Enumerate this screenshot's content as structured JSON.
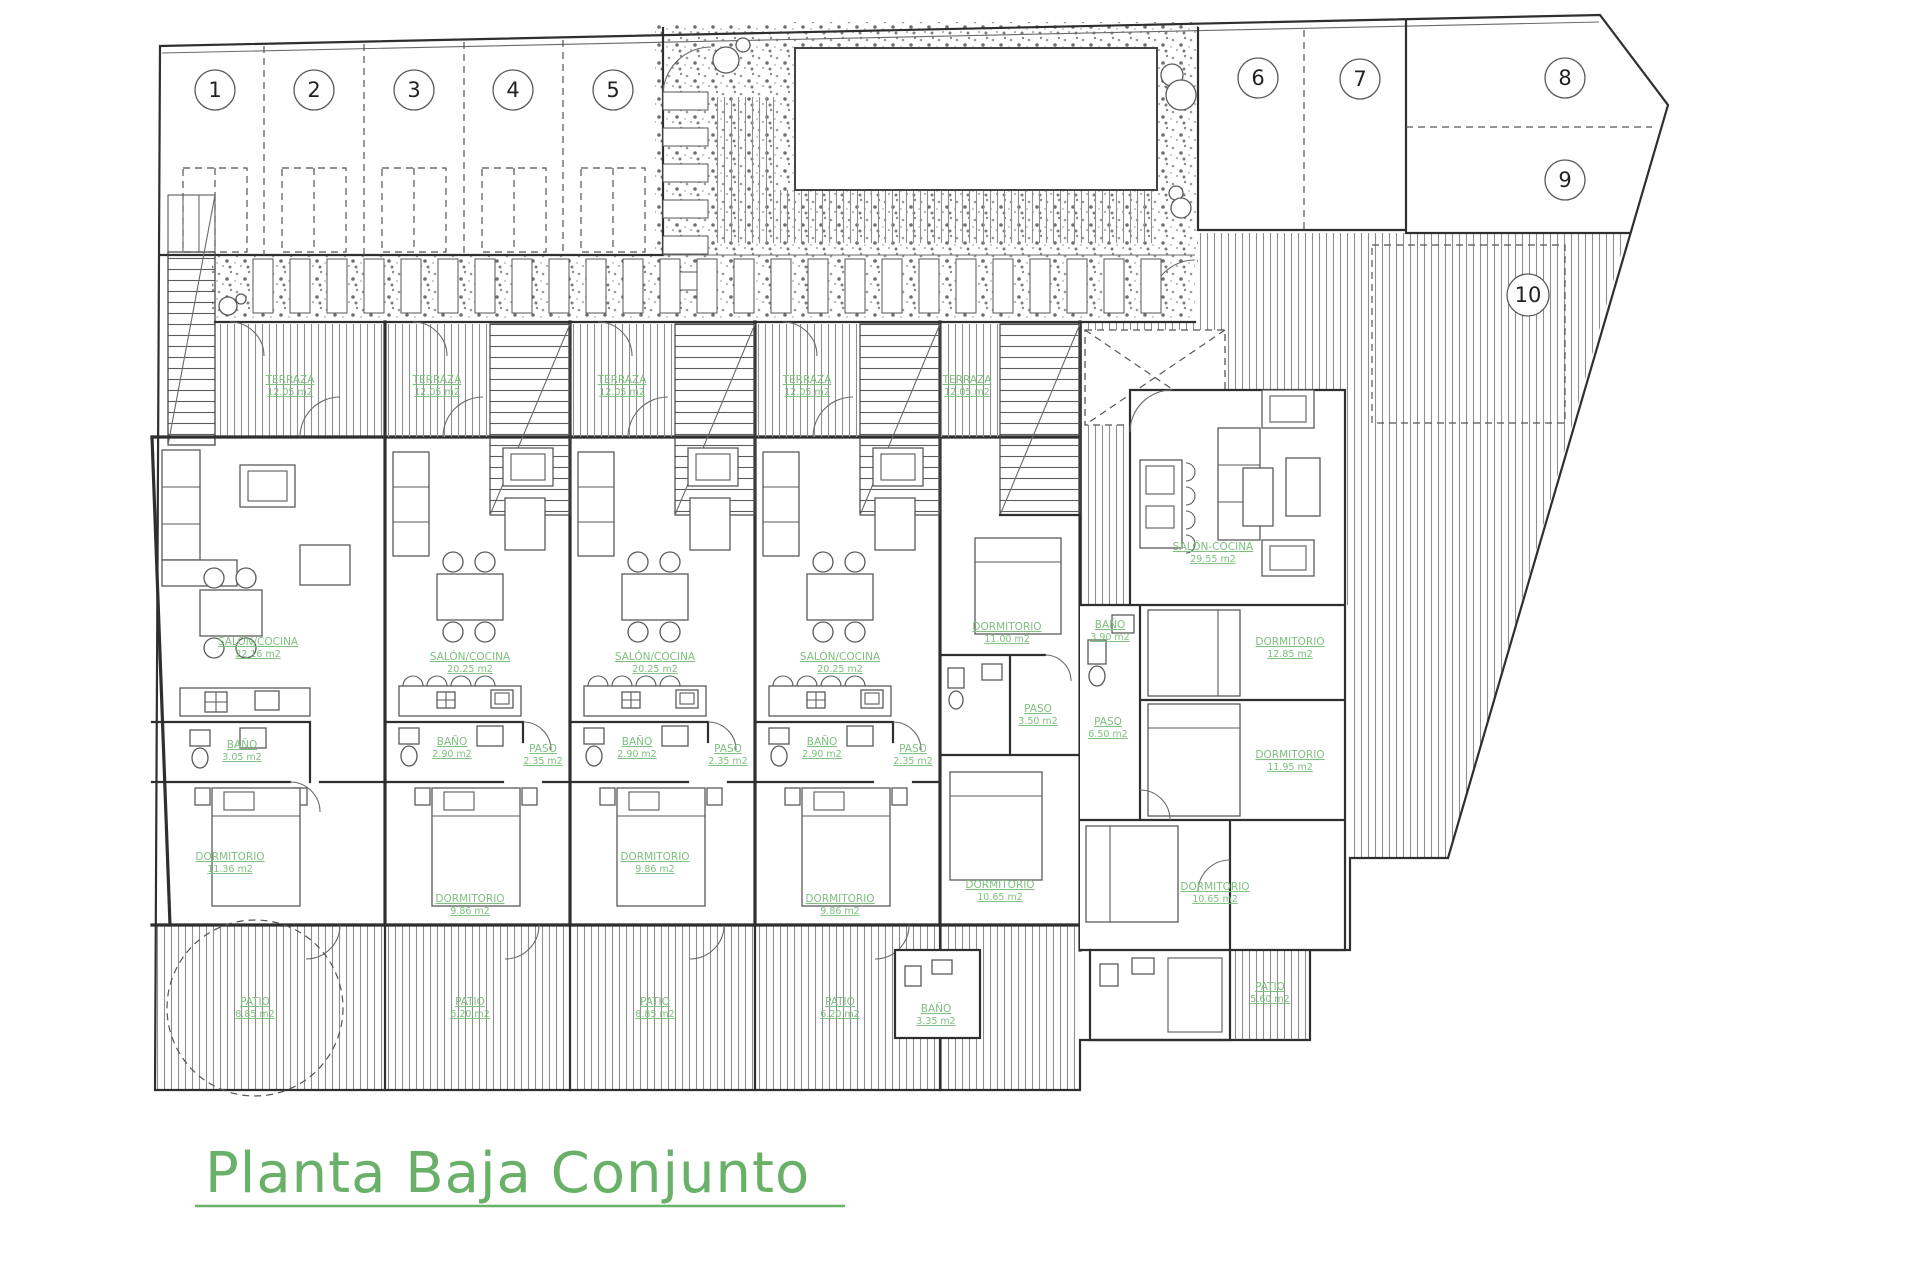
{
  "title": {
    "text": "Planta Baja Conjunto"
  },
  "parking": {
    "numbers": [
      "1",
      "2",
      "3",
      "4",
      "5",
      "6",
      "7",
      "8",
      "9",
      "10"
    ]
  },
  "rooms": [
    {
      "name": "TERRAZA",
      "area": "12.05 m2"
    },
    {
      "name": "TERRAZA",
      "area": "12.05 m2"
    },
    {
      "name": "TERRAZA",
      "area": "12.05 m2"
    },
    {
      "name": "TERRAZA",
      "area": "12.05 m2"
    },
    {
      "name": "TERRAZA",
      "area": "12.05 m2"
    },
    {
      "name": "SALÓN/COCINA",
      "area": "22.16 m2"
    },
    {
      "name": "SALÓN/COCINA",
      "area": "20.25 m2"
    },
    {
      "name": "SALÓN/COCINA",
      "area": "20.25 m2"
    },
    {
      "name": "SALÓN/COCINA",
      "area": "20.25 m2"
    },
    {
      "name": "BAÑO",
      "area": "3.05 m2"
    },
    {
      "name": "BAÑO",
      "area": "2.90 m2"
    },
    {
      "name": "BAÑO",
      "area": "2.90 m2"
    },
    {
      "name": "BAÑO",
      "area": "2.90 m2"
    },
    {
      "name": "PASO",
      "area": "2.35 m2"
    },
    {
      "name": "PASO",
      "area": "2.35 m2"
    },
    {
      "name": "PASO",
      "area": "2.35 m2"
    },
    {
      "name": "DORMITORIO",
      "area": "11.36 m2"
    },
    {
      "name": "DORMITORIO",
      "area": "9.86 m2"
    },
    {
      "name": "DORMITORIO",
      "area": "9.86 m2"
    },
    {
      "name": "DORMITORIO",
      "area": "9.86 m2"
    },
    {
      "name": "DORMITORIO",
      "area": "11.00 m2"
    },
    {
      "name": "PASO",
      "area": "3.50 m2"
    },
    {
      "name": "DORMITORIO",
      "area": "10.65 m2"
    },
    {
      "name": "PATIO",
      "area": "8.85 m2"
    },
    {
      "name": "PATIO",
      "area": "6.20 m2"
    },
    {
      "name": "PATIO",
      "area": "8.85 m2"
    },
    {
      "name": "PATIO",
      "area": "6.20 m2"
    },
    {
      "name": "BAÑO",
      "area": "3.35 m2"
    },
    {
      "name": "SALÓN-COCINA",
      "area": "29.55 m2"
    },
    {
      "name": "BAÑO",
      "area": "3.90 m2"
    },
    {
      "name": "DORMITORIO",
      "area": "12.85 m2"
    },
    {
      "name": "PASO",
      "area": "6.50 m2"
    },
    {
      "name": "DORMITORIO",
      "area": "11.95 m2"
    },
    {
      "name": "DORMITORIO",
      "area": "10.65 m2"
    },
    {
      "name": "PATIO",
      "area": "5.60 m2"
    }
  ],
  "colors": {
    "label_green": "#7fbf7f",
    "title_green": "#69b069",
    "line_dark": "#2f2f2f",
    "hatch_gray": "#8e8e8e"
  }
}
